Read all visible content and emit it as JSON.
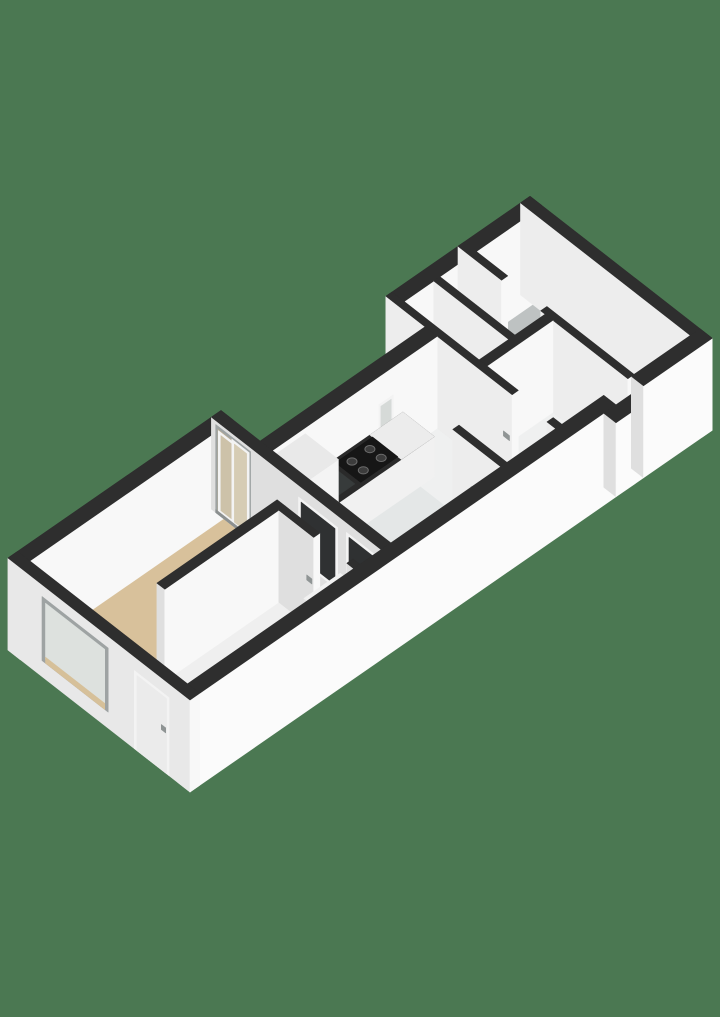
{
  "scene": {
    "description": "3D isometric floor plan of an elongated apartment on a green background: living room with beige floor and sliding glass doors, small bedroom, galley kitchen with dark counter and gas cooktop, hallway, two small rooms and a bathroom at the far end",
    "canvas": {
      "width": 720,
      "height": 1017
    },
    "background_color": "#4B7852",
    "projection": {
      "ox": 47.2,
      "oy": 680.6,
      "u": [
        0.687,
        -0.476
      ],
      "v": [
        0.871,
        0.679
      ],
      "wall_height": 92
    },
    "rooms": [
      {
        "name": "living-room",
        "floor": "floorLiving"
      },
      {
        "name": "bedroom",
        "floor": "floorSmall"
      },
      {
        "name": "kitchen",
        "floor": "floorKitchen"
      },
      {
        "name": "hallway",
        "floor": "floorHall"
      },
      {
        "name": "small-room-a",
        "floor": "floorSmall"
      },
      {
        "name": "small-room-b",
        "floor": "floorSmall"
      },
      {
        "name": "bathroom",
        "floor": "floorBath"
      }
    ],
    "colors": {
      "background": "#4B7852",
      "wallTop": "#2E2E2E",
      "faceSE": "#F8F8F8",
      "faceSW": "#DFDFDF",
      "facadeSE": "#FBFBFB",
      "facadeSW": "#E8E8E8",
      "innerEnd": "#EDEDED",
      "floorLiving": "#D8C19B",
      "floorKitchen": "#E4E7E7",
      "floorHall": "#EFF0F0",
      "floorSmall": "#EFEFEF",
      "floorBath": "#BEC2C2",
      "threshold": "#E6E6E6",
      "counterTop": "#2A2A2A",
      "counterLight": "#ECECEC",
      "counterFace": "#F1F1F1",
      "counterCap": "#E0E0E0",
      "cabTop": "#E9E9E9",
      "cabFace": "#F4F4F4",
      "cabCap": "#DCDCDC",
      "cooktop": "#161616",
      "burner": "#3C3C3C",
      "burnerRim": "#6B6B6B",
      "sinkDark": "#373B3B",
      "chrome": "#C7CBCB",
      "frameGray": "#9EA3A3",
      "frameWhite": "#F3F3F3",
      "trackGray": "#8C9090",
      "glassDim": "#B7AD97",
      "glassBeige": "#CDC2A9",
      "glassBeige2": "#D6CCB4",
      "glassGray": "#D6DAD8",
      "glassGray2": "#DDE1DE",
      "sillBeige": "#D6C099",
      "darkOpen": "#2F3132",
      "doorTop": "#F1F1F1",
      "doorFace": "#F7F7F7",
      "doorCap": "#E3E3E3",
      "doorPanel": "#EBEBEB",
      "handle": "#8F9494"
    },
    "draw": [
      {
        "t": "qT",
        "n": "bathroom-floor",
        "u": [
          664,
          746
        ],
        "v": [
          -31,
          150
        ],
        "h": 0,
        "c": "floorBath"
      },
      {
        "t": "qT",
        "n": "small-room-b-floor",
        "u": [
          611,
          655
        ],
        "v": [
          -31,
          55
        ],
        "h": 0,
        "c": "floorSmall"
      },
      {
        "t": "qT",
        "n": "small-room-a-floor",
        "u": [
          559,
          602
        ],
        "v": [
          -31,
          55
        ],
        "h": 0,
        "c": "floorSmall"
      },
      {
        "t": "qT",
        "n": "bathroom-doorway-floor",
        "u": [
          655,
          664
        ],
        "v": [
          5,
          50
        ],
        "h": 0,
        "c": "floorSmall"
      },
      {
        "t": "qT",
        "n": "end-hall-floor",
        "u": [
          559,
          655
        ],
        "v": [
          64,
          150
        ],
        "h": 0,
        "c": "floorHall"
      },
      {
        "t": "qT",
        "n": "hall-doorway-floor",
        "u": [
          550,
          559
        ],
        "v": [
          100,
          140
        ],
        "h": 0,
        "c": "floorHall"
      },
      {
        "t": "qT",
        "n": "hallway-floor",
        "u": [
          479,
          550
        ],
        "v": [
          14,
          150
        ],
        "h": 0,
        "c": "floorHall"
      },
      {
        "t": "qT",
        "n": "kitchen-floor",
        "u": [
          310,
          479
        ],
        "v": [
          14,
          150
        ],
        "h": 0,
        "c": "floorKitchen"
      },
      {
        "t": "qT",
        "n": "living-room-floor",
        "u": [
          14,
          296
        ],
        "v": [
          -31,
          150
        ],
        "h": 0,
        "c": "floorLiving"
      },
      {
        "t": "qT",
        "n": "bedroom-floor",
        "u": [
          99,
          256
        ],
        "v": [
          64,
          150
        ],
        "h": 0,
        "c": "floorSmall"
      },
      {
        "t": "qT",
        "n": "bedroom-threshold",
        "u": [
          256,
          265
        ],
        "v": [
          104,
          142
        ],
        "h": 1,
        "c": "threshold"
      },
      {
        "t": "slab",
        "n": "end-nw-wall",
        "u": [
          550,
          760
        ],
        "v": [
          -45,
          -31
        ]
      },
      {
        "t": "slab",
        "n": "end-ne-wall",
        "u": [
          746,
          760
        ],
        "v": [
          -45,
          164
        ],
        "sw": "innerEnd"
      },
      {
        "t": "slab",
        "n": "bathroom-wall-nw",
        "u": [
          655,
          664
        ],
        "v": [
          -45,
          5
        ],
        "sw": "innerEnd"
      },
      {
        "t": "slab",
        "n": "bathroom-wall-se",
        "u": [
          655,
          664
        ],
        "v": [
          50,
          150
        ],
        "sw": "innerEnd"
      },
      {
        "t": "slab",
        "n": "small-rooms-divider",
        "u": [
          602,
          611
        ],
        "v": [
          -31,
          55
        ],
        "sw": "innerEnd"
      },
      {
        "t": "slab",
        "n": "small-rooms-corridor-wall",
        "u": [
          559,
          655
        ],
        "v": [
          55,
          64
        ],
        "sw": "innerEnd"
      },
      {
        "t": "slab",
        "n": "end-cross-wall-nw",
        "u": [
          550,
          559
        ],
        "v": [
          -45,
          100
        ],
        "sw": "innerEnd"
      },
      {
        "t": "slab",
        "n": "end-cross-wall-se",
        "u": [
          550,
          559
        ],
        "v": [
          140,
          150
        ],
        "sw": "innerEnd"
      },
      {
        "t": "qSW",
        "n": "hall-door-handle",
        "u": 550,
        "v": [
          90,
          97
        ],
        "h": [
          44,
          49
        ],
        "c": "handle"
      },
      {
        "t": "slab",
        "n": "kitchen-nw-wall",
        "u": [
          310,
          550
        ],
        "v": [
          0,
          14
        ]
      },
      {
        "t": "qSE",
        "n": "kitchen-window-frame",
        "v": 14,
        "u": [
          465,
          486
        ],
        "h": [
          36,
          64
        ],
        "c": "frameWhite"
      },
      {
        "t": "qSE",
        "n": "kitchen-window-glass",
        "v": 14,
        "u": [
          468,
          483
        ],
        "h": [
          39,
          61
        ],
        "c": "glassGray"
      },
      {
        "t": "slab",
        "n": "kitchen-counter",
        "u": [
          358,
          500
        ],
        "v": [
          14,
          50
        ],
        "h": 40,
        "top": "counterTop",
        "se": "counterFace",
        "sw": "counterCap"
      },
      {
        "t": "qT",
        "n": "kitchen-counter-light-top",
        "u": [
          452,
          500
        ],
        "v": [
          14,
          50
        ],
        "h": 40,
        "c": "counterLight"
      },
      {
        "t": "qT",
        "n": "cooktop",
        "u": [
          398,
          452
        ],
        "v": [
          17,
          46
        ],
        "h": 40,
        "c": "cooktop"
      },
      {
        "t": "circ",
        "n": "burner",
        "u": 412,
        "v": 25,
        "h": 40,
        "rx": 5,
        "ry": 3.6,
        "c": "burner",
        "sc": "burnerRim"
      },
      {
        "t": "circ",
        "n": "burner",
        "u": 412,
        "v": 38,
        "h": 40,
        "rx": 5,
        "ry": 3.6,
        "c": "burner",
        "sc": "burnerRim"
      },
      {
        "t": "circ",
        "n": "burner",
        "u": 438,
        "v": 25,
        "h": 40,
        "rx": 5,
        "ry": 3.6,
        "c": "burner",
        "sc": "burnerRim"
      },
      {
        "t": "circ",
        "n": "burner",
        "u": 438,
        "v": 38,
        "h": 40,
        "rx": 5,
        "ry": 3.6,
        "c": "burner",
        "sc": "burnerRim"
      },
      {
        "t": "qT",
        "n": "kitchen-sink",
        "u": [
          362,
          392
        ],
        "v": [
          20,
          44
        ],
        "h": 40,
        "c": "sinkDark"
      },
      {
        "t": "seg",
        "n": "faucet",
        "a": [
          366,
          21,
          40
        ],
        "b": [
          366,
          21,
          57
        ],
        "w": 2.6,
        "c": "chrome"
      },
      {
        "t": "seg",
        "n": "faucet-spout",
        "a": [
          366,
          21,
          55
        ],
        "b": [
          366,
          30,
          53
        ],
        "w": 2.2,
        "c": "chrome"
      },
      {
        "t": "slab",
        "n": "kitchen-tall-cabinet",
        "u": [
          312,
          358
        ],
        "v": [
          14,
          52
        ],
        "h": 86,
        "top": "cabTop",
        "se": "cabFace",
        "sw": "cabCap"
      },
      {
        "t": "slab",
        "n": "kitchen-stub-wall",
        "u": [
          470,
          479
        ],
        "v": [
          95,
          150
        ],
        "sw": "innerEnd"
      },
      {
        "t": "qSW",
        "n": "stub-door-handle",
        "u": 470,
        "v": [
          116,
          124
        ],
        "h": [
          44,
          49
        ],
        "c": "handle"
      },
      {
        "t": "slab",
        "n": "living-nw-wall",
        "u": [
          0,
          310
        ],
        "v": [
          -45,
          -31
        ]
      },
      {
        "t": "slab",
        "n": "living-kitchen-wall",
        "u": [
          296,
          310
        ],
        "v": [
          -45,
          150
        ]
      },
      {
        "t": "qSW",
        "n": "sliding-door-frame",
        "u": 296,
        "v": [
          -40,
          0
        ],
        "h": [
          0,
          88
        ],
        "c": "frameGray"
      },
      {
        "t": "qSW",
        "n": "sliding-door-backdrop",
        "u": 296,
        "v": [
          -37.5,
          -2.5
        ],
        "h": [
          2,
          85
        ],
        "c": "glassDim"
      },
      {
        "t": "qSW",
        "n": "sliding-door-panel1-frame",
        "u": 296,
        "v": [
          -37,
          -16
        ],
        "h": [
          3,
          84
        ],
        "c": "frameWhite"
      },
      {
        "t": "qSW",
        "n": "sliding-door-panel1-glass",
        "u": 296,
        "v": [
          -34,
          -19
        ],
        "h": [
          6,
          81
        ],
        "c": "glassBeige"
      },
      {
        "t": "qSW",
        "n": "sliding-door-panel2-frame",
        "u": 294,
        "v": [
          -20,
          0
        ],
        "h": [
          4,
          88
        ],
        "c": "frameWhite"
      },
      {
        "t": "qSW",
        "n": "sliding-door-panel2-glass",
        "u": 294,
        "v": [
          -17,
          -3
        ],
        "h": [
          7,
          85
        ],
        "c": "glassBeige2"
      },
      {
        "t": "qSW",
        "n": "sliding-door-track",
        "u": 296,
        "v": [
          -40,
          0
        ],
        "h": [
          0,
          3
        ],
        "c": "trackGray"
      },
      {
        "t": "qSW",
        "n": "kitchen-pass-window-frame",
        "u": 296,
        "v": [
          55,
          100
        ],
        "h": [
          18,
          80
        ],
        "c": "frameWhite"
      },
      {
        "t": "qSW",
        "n": "kitchen-pass-window-dark",
        "u": 296,
        "v": [
          58,
          97
        ],
        "h": [
          21,
          77
        ],
        "c": "darkOpen"
      },
      {
        "t": "qSW",
        "n": "kitchen-doorway-frame",
        "u": 296,
        "v": [
          110,
          148
        ],
        "h": [
          0,
          82
        ],
        "c": "frameWhite"
      },
      {
        "t": "qSW",
        "n": "kitchen-doorway-dark",
        "u": 296,
        "v": [
          113,
          148
        ],
        "h": [
          0,
          79
        ],
        "c": "darkOpen"
      },
      {
        "t": "slab",
        "n": "bedroom-nw-wall",
        "u": [
          90,
          265
        ],
        "v": [
          55,
          64
        ]
      },
      {
        "t": "slab",
        "n": "bedroom-ne-wall",
        "u": [
          256,
          265
        ],
        "v": [
          64,
          104
        ]
      },
      {
        "t": "slab",
        "n": "bedroom-ne-wall-b",
        "u": [
          256,
          265
        ],
        "v": [
          142,
          150
        ]
      },
      {
        "t": "qSW",
        "n": "bedroom-door-handle",
        "u": 256,
        "v": [
          96,
          102
        ],
        "h": [
          44,
          49
        ],
        "c": "handle"
      },
      {
        "t": "slab",
        "n": "bedroom-door-leaf",
        "u": [
          200,
          253
        ],
        "v": [
          137,
          141
        ],
        "h": 80,
        "top": "doorTop",
        "se": "doorFace",
        "sw": "doorCap"
      },
      {
        "t": "slab",
        "n": "se-facade",
        "u": [
          0,
          620
        ],
        "v": [
          150,
          164
        ],
        "se": "facadeSE"
      },
      {
        "t": "slab",
        "n": "se-facade-entrance-lintel",
        "u": [
          620,
          660
        ],
        "v": [
          150,
          164
        ],
        "h": 74,
        "se": "facadeSE"
      },
      {
        "t": "slab",
        "n": "se-facade-end",
        "u": [
          660,
          760
        ],
        "v": [
          150,
          164
        ],
        "se": "facadeSE"
      },
      {
        "t": "slab",
        "n": "west-wall",
        "u": [
          0,
          14
        ],
        "v": [
          -45,
          164
        ],
        "sw": "facadeSW"
      },
      {
        "t": "qSW",
        "n": "west-window-frame",
        "u": 0,
        "v": [
          -6,
          70
        ],
        "h": [
          16,
          80
        ],
        "c": "frameGray"
      },
      {
        "t": "qSW",
        "n": "west-window-glass",
        "u": 0,
        "v": [
          -2,
          66
        ],
        "h": [
          20,
          76
        ],
        "c": "glassGray2"
      },
      {
        "t": "qSW",
        "n": "west-window-sill",
        "u": 0,
        "v": [
          -2,
          66
        ],
        "h": [
          16,
          22
        ],
        "c": "sillBeige"
      },
      {
        "t": "qSW",
        "n": "entry-door-frame",
        "u": 0,
        "v": [
          100,
          140
        ],
        "h": [
          0,
          78
        ],
        "c": "frameWhite"
      },
      {
        "t": "qSW",
        "n": "entry-door-panel",
        "u": 0,
        "v": [
          103,
          137
        ],
        "h": [
          0,
          75
        ],
        "c": "doorPanel"
      },
      {
        "t": "qSW",
        "n": "entry-door-handle",
        "u": 0,
        "v": [
          131,
          136
        ],
        "h": [
          40,
          45
        ],
        "c": "handle"
      }
    ]
  }
}
